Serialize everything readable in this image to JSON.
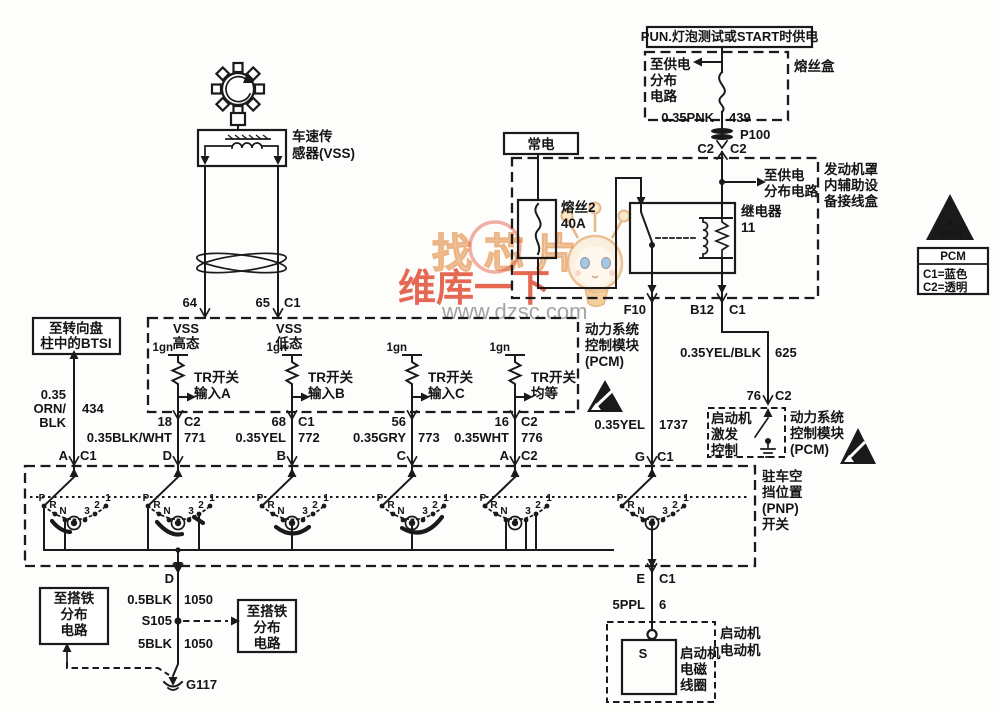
{
  "watermark": {
    "stamp": "找芯片",
    "brand": "维库一下",
    "site": "www.dzsc.com"
  },
  "power": {
    "hot_in_run": "PUN.灯泡测试或START时供电",
    "fusebox": "熔丝盒",
    "to_supply_fusebox": [
      "至供电",
      "分布",
      "电路"
    ],
    "wire_pnk": "0.35PNK",
    "wire_pnk_circuit": "439",
    "p100": "P100",
    "p100_pin_l": "C2",
    "p100_pin_r": "C2",
    "to_supply_ujb": [
      "至供电",
      "分布电路"
    ],
    "ujb": [
      "发动机罩",
      "内辅助设",
      "备接线盒"
    ],
    "hot_always": "常电",
    "fuse2": [
      "熔丝2",
      "40A"
    ],
    "relay": [
      "继电器",
      "11"
    ],
    "pin_f10": "F10",
    "pin_b12": "B12",
    "pin_b12_conn": "C1"
  },
  "vss": {
    "label": [
      "车速传",
      "感器(VSS)"
    ],
    "pin64": "64",
    "pin65": "65",
    "pin65_conn": "C1"
  },
  "pcm1": {
    "label": [
      "动力系统",
      "控制模块",
      "(PCM)"
    ],
    "vss_high": [
      "VSS",
      "高态"
    ],
    "vss_low": [
      "VSS",
      "低态"
    ],
    "ign": "1gn",
    "tr_a": [
      "TR开关",
      "输入A"
    ],
    "tr_b": [
      "TR开关",
      "输入B"
    ],
    "tr_c": [
      "TR开关",
      "输入C"
    ],
    "tr_d": [
      "TR开关",
      "均等"
    ],
    "pins": {
      "p18": "18",
      "p18c": "C2",
      "p68": "68",
      "p68c": "C1",
      "p56": "56",
      "p16": "16",
      "p16c": "C2"
    },
    "wires": {
      "w1": "0.35BLK/WHT",
      "c1": "771",
      "w2": "0.35YEL",
      "c2": "772",
      "w3": "0.35GRY",
      "c3": "773",
      "w4": "0.35WHT",
      "c4": "776"
    },
    "letters": {
      "d": "D",
      "b": "B",
      "c": "C",
      "a": "A",
      "ac": "C2"
    }
  },
  "btsi": {
    "label": [
      "至转向盘",
      "柱中的BTSI"
    ],
    "wire": [
      "0.35",
      "ORN/",
      "BLK"
    ],
    "circuit": "434",
    "pin": "A",
    "conn": "C1"
  },
  "relay_out": {
    "wire_yel": "0.35YEL",
    "wire_yel_circuit": "1737",
    "pin_g": "G",
    "pin_g_conn": "C1",
    "wire_yelblk": "0.35YEL/BLK",
    "wire_yelblk_circuit": "625",
    "pin76": "76",
    "pin76_conn": "C2"
  },
  "pcm2": {
    "trigger": [
      "启动机",
      "激发",
      "控制"
    ],
    "label": [
      "动力系统",
      "控制模块",
      "(PCM)"
    ]
  },
  "pnp": {
    "label": [
      "驻车空",
      "挡位置",
      "(PNP)",
      "开关"
    ],
    "positions": [
      "P",
      "R",
      "N",
      "3",
      "2",
      "1"
    ]
  },
  "ground": {
    "pin_d": "D",
    "w1": "0.5BLK",
    "w1c": "1050",
    "splice": "S105",
    "w2": "5BLK",
    "w2c": "1050",
    "gnd": "G117",
    "left_box": [
      "至搭铁",
      "分布",
      "电路"
    ],
    "right_box": [
      "至搭铁",
      "分布",
      "电路"
    ]
  },
  "starter": {
    "pin_e": "E",
    "pin_e_conn": "C1",
    "wire": "5PPL",
    "circuit": "6",
    "s": "S",
    "solenoid": [
      "启动机",
      "电磁",
      "线圈"
    ],
    "motor": [
      "启动机",
      "电动机"
    ]
  },
  "legend": {
    "obd1": "II",
    "obd2": "OBDII",
    "title": "PCM",
    "c1": "C1=蓝色",
    "c2": "C2=透明"
  }
}
